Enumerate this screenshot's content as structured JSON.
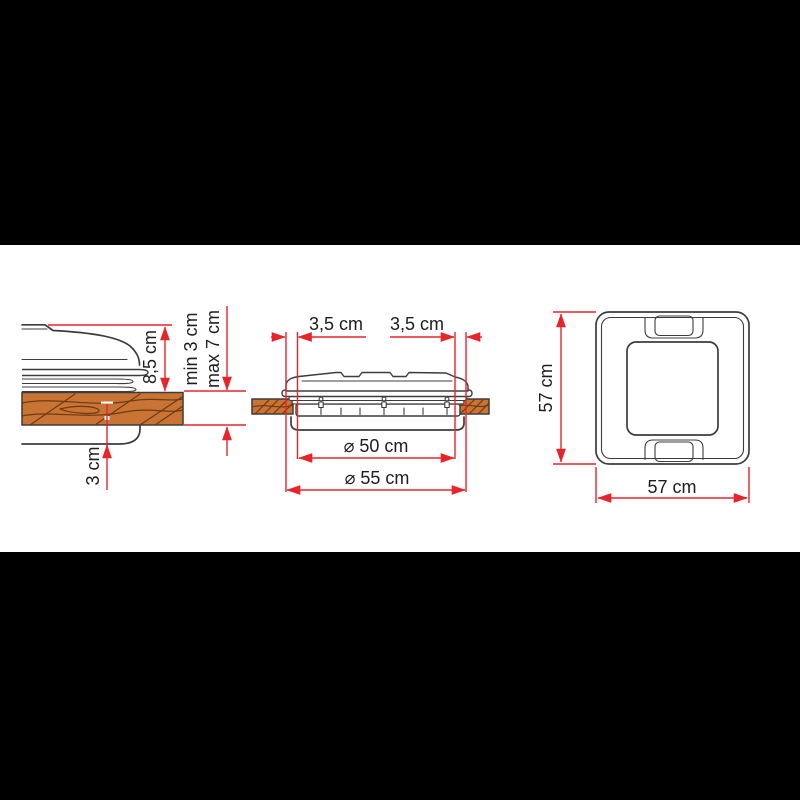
{
  "window": {
    "background": "#000000",
    "canvas_background": "#ffffff"
  },
  "colors": {
    "dimension": "#e8242b",
    "drawing_line": "#3c3c3c",
    "text": "#1d1d1d",
    "wood_fill": "#c97434",
    "wood_grain": "#6e3a12"
  },
  "diagram": {
    "side_view": {
      "labels": {
        "lid_height": "8,5 cm",
        "roof_thickness_min": "min 3 cm",
        "roof_thickness_max": "max 7 cm",
        "inner_frame_depth": "3 cm"
      }
    },
    "section_view": {
      "labels": {
        "flange_left": "3,5 cm",
        "flange_right": "3,5 cm",
        "cutout_width": "⌀ 50 cm",
        "overall_width": "⌀ 55 cm"
      }
    },
    "top_view": {
      "labels": {
        "height": "57 cm",
        "width": "57 cm"
      }
    }
  }
}
